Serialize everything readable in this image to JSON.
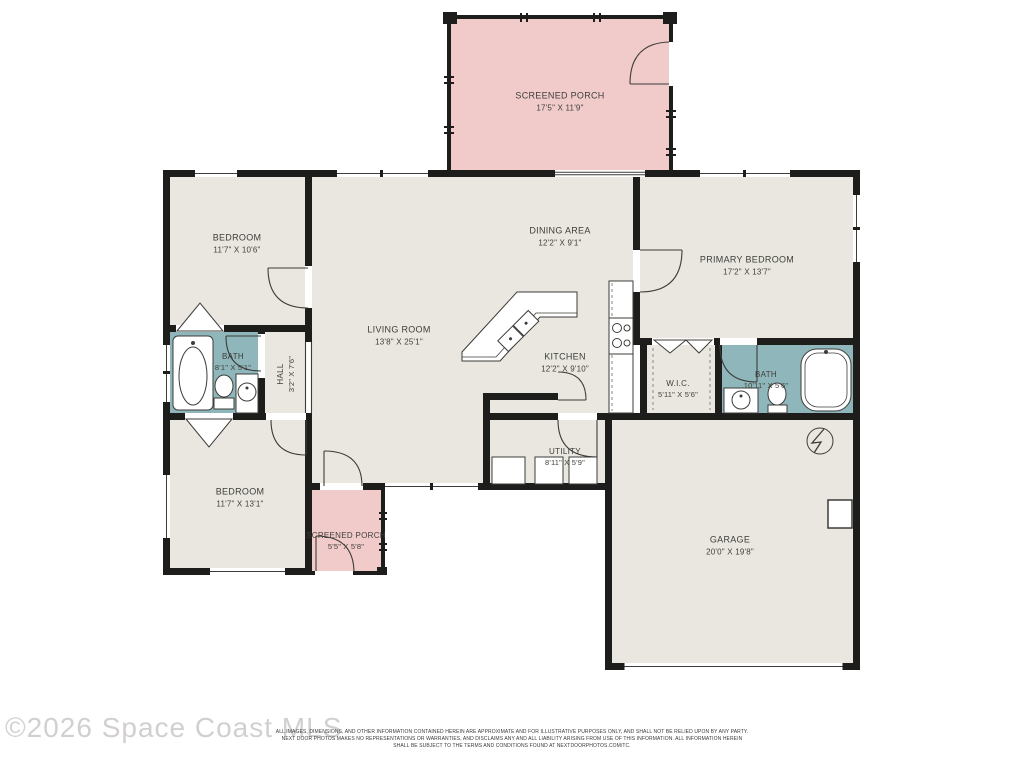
{
  "watermark": "©2026 Space Coast MLS",
  "disclaimer": {
    "line1": "ALL IMAGES, DIMENSIONS, AND OTHER INFORMATION CONTAINED HEREIN ARE APPROXIMATE AND FOR ILLUSTRATIVE PURPOSES ONLY, AND SHALL NOT BE RELIED UPON BY ANY PARTY.",
    "line2": "NEXT DOOR PHOTOS MAKES NO REPRESENTATIONS OR WARRANTIES, AND DISCLAIMS ANY AND ALL LIABILITY ARISING FROM USE OF THIS INFORMATION. ALL INFORMATION HEREIN",
    "line3": "SHALL BE SUBJECT TO THE TERMS AND CONDITIONS FOUND AT NEXTDOORPHOTOS.COM/TC."
  },
  "colors": {
    "room_fill": "#e9e7df",
    "porch_fill": "#f1cbca",
    "bath_fill": "#8fb6ba",
    "wall": "#1d1d1b",
    "line": "#3c3c3a",
    "label_text": "#3e3e3b",
    "watermark_text": "#d2d0cf"
  },
  "rooms": {
    "screened_porch_top": {
      "name": "SCREENED PORCH",
      "dims": "17'5\" X 11'9\""
    },
    "bedroom_top": {
      "name": "BEDROOM",
      "dims": "11'7\" X 10'6\""
    },
    "dining": {
      "name": "DINING AREA",
      "dims": "12'2\" X 9'1\""
    },
    "primary_bedroom": {
      "name": "PRIMARY BEDROOM",
      "dims": "17'2\" X 13'7\""
    },
    "living": {
      "name": "LIVING ROOM",
      "dims": "13'8\" X 25'1\""
    },
    "kitchen": {
      "name": "KITCHEN",
      "dims": "12'2\" X 9'10\""
    },
    "bath_left": {
      "name": "BATH",
      "dims": "8'1\" X 5'1\""
    },
    "hall": {
      "name": "HALL",
      "dims": "3'2\" X 7'6\""
    },
    "wic": {
      "name": "W.I.C.",
      "dims": "5'11\" X 5'6\""
    },
    "bath_right": {
      "name": "BATH",
      "dims": "10'11\" X 5'6\""
    },
    "utility": {
      "name": "UTILITY",
      "dims": "8'11\" X 5'9\""
    },
    "bedroom_bottom": {
      "name": "BEDROOM",
      "dims": "11'7\" X 13'1\""
    },
    "screened_porch_bottom": {
      "name": "SCREENED PORCH",
      "dims": "5'5\" X 5'8\""
    },
    "garage": {
      "name": "GARAGE",
      "dims": "20'0\" X 19'8\""
    }
  },
  "fixtures": [
    "bathtub",
    "toilet",
    "sink-vanity",
    "shower-tub",
    "kitchen-island-sink",
    "stove",
    "washer-dryer-units",
    "water-heater",
    "closet-bifold-doors"
  ]
}
